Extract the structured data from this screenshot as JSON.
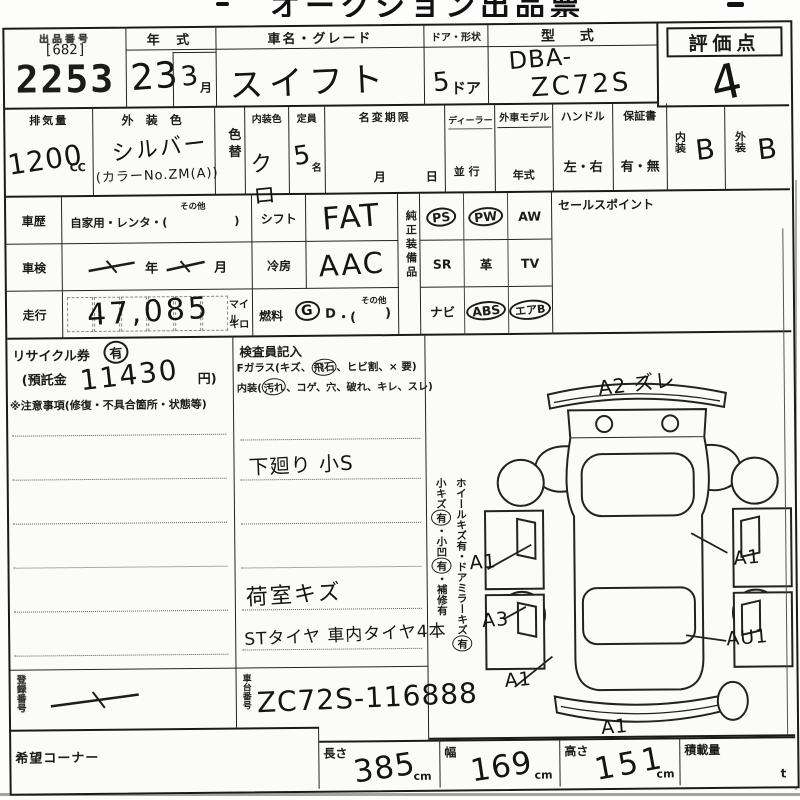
{
  "page": {
    "clipped_title": "オークション出品票"
  },
  "lot": {
    "label": "出品番号",
    "bracket": "[682]",
    "number": "2253"
  },
  "year": {
    "label": "年 式",
    "value": "23",
    "month_value": "3",
    "month_unit": "月"
  },
  "car": {
    "label": "車名・グレード",
    "value": "スイフト"
  },
  "doors": {
    "label": "ドア・形状",
    "value_num": "5",
    "value_unit": "ドア"
  },
  "model": {
    "label": "型  式",
    "line1": "DBA-",
    "line2": "ZC72S"
  },
  "score": {
    "label": "評価点",
    "value": "4"
  },
  "displacement": {
    "label": "排気量",
    "value": "1200",
    "unit": "CC"
  },
  "exterior_color": {
    "label": "外 装 色",
    "value": "シルバー",
    "color_no": "(カラーNo.ZM(A))"
  },
  "color_change": {
    "label": "色替"
  },
  "interior_color": {
    "label": "内装色",
    "value": "クロ"
  },
  "capacity": {
    "label": "定員",
    "value": "5",
    "unit": "名"
  },
  "name_change": {
    "label": "名変期限",
    "month": "月",
    "day": "日"
  },
  "dealer": {
    "label": "ディーラー",
    "sub": "並 行"
  },
  "import_model": {
    "label": "外車モデル",
    "sub": "年式"
  },
  "handle": {
    "label": "ハンドル",
    "value": "左・右"
  },
  "warranty": {
    "label": "保証書",
    "value": "有・無"
  },
  "interior_grade": {
    "label": "内装",
    "value": "B"
  },
  "exterior_grade": {
    "label": "外装",
    "value": "B"
  },
  "history": {
    "label": "車歴",
    "text": "自家用・レンタ・(",
    "other": "その他",
    "close": ")"
  },
  "shift": {
    "label": "シフト",
    "value": "FAT"
  },
  "inspection": {
    "label": "車検",
    "year_unit": "年",
    "month_unit": "月"
  },
  "cooling": {
    "label": "冷房",
    "value": "AAC"
  },
  "mileage": {
    "label": "走行",
    "value": "47,085",
    "unit_top": "マイル",
    "unit_bottom": "キロ"
  },
  "fuel": {
    "label": "燃料",
    "g": "G",
    "mid": "・",
    "d": "D",
    "paren": "・(",
    "other": "その他",
    "close": ")"
  },
  "equipment": {
    "label": "純正装備品",
    "items": [
      {
        "label": "PS",
        "circled": true
      },
      {
        "label": "PW",
        "circled": true
      },
      {
        "label": "AW",
        "circled": false
      },
      {
        "label": "SR",
        "circled": false
      },
      {
        "label": "革",
        "circled": false
      },
      {
        "label": "TV",
        "circled": false
      },
      {
        "label": "ナビ",
        "circled": false
      },
      {
        "label": "ABS",
        "circled": true
      },
      {
        "label": "エアB",
        "circled": true
      }
    ]
  },
  "sales_point": {
    "label": "セールスポイント"
  },
  "recycle": {
    "label": "リサイクル券",
    "value": "有",
    "deposit_open": "(預託金",
    "deposit_value": "11430",
    "deposit_close": "円)"
  },
  "caution": {
    "label": "※注意事項(修復・不具合箇所・状態等)"
  },
  "inspector": {
    "label": "検査員記入",
    "glass_pre": "Fガラス(キズ、",
    "glass_circled": "飛石",
    "glass_post": "、ヒビ割、× 要)",
    "interior_pre": "内装(",
    "interior_circled": "汚れ",
    "interior_post": "、コゲ、穴、破れ、キレ、スレ)",
    "note1": "下廻り 小S",
    "note2": "荷室キズ",
    "note3": "STタイヤ 車内タイヤ4本"
  },
  "side_notes": {
    "line1_pre": "ホイールキズ有・ドアミラーキズ",
    "line1_circled": "有",
    "line2_p1": "小キズ",
    "line2_c1": "有",
    "line2_p2": "・小凹",
    "line2_c2": "有",
    "line2_p3": "・補修有"
  },
  "diagram": {
    "marks": {
      "top": "A2 ズレ",
      "right_front": "A1",
      "left_front": "A1",
      "left_mid": "A3",
      "left_rear": "A1",
      "right_rear": "AU1",
      "bottom": "A1"
    }
  },
  "chassis": {
    "label": "車台番号",
    "value": "ZC72S-116888"
  },
  "registration": {
    "label": "登録番号"
  },
  "corner": {
    "label": "希望コーナー"
  },
  "dimensions": {
    "length_label": "長さ",
    "length_value": "385",
    "length_unit": "cm",
    "width_label": "幅",
    "width_value": "169",
    "width_unit": "cm",
    "height_label": "高さ",
    "height_value": "151",
    "height_unit": "cm",
    "payload_label": "積載量",
    "payload_unit": "t"
  }
}
